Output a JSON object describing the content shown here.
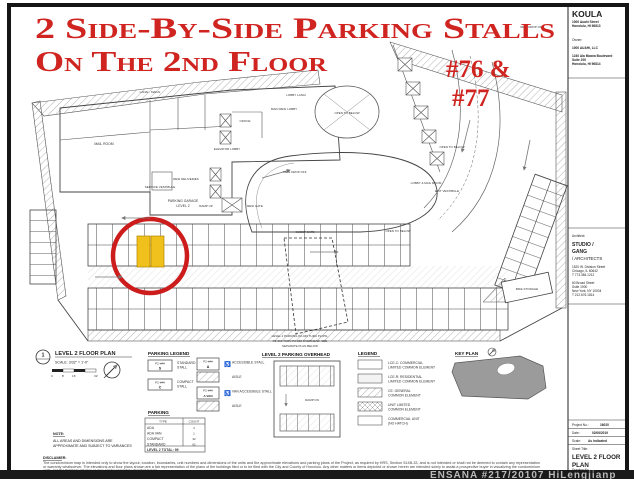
{
  "annotations": {
    "headline_line1": "2 Side-By-Side Parking Stalls",
    "headline_line2": "On The 2nd Floor",
    "callout_line1": "#76 &",
    "callout_line2": "#77",
    "accent_color": "#cf2420",
    "highlight_color": "#f0c11d"
  },
  "title_block": {
    "project": {
      "name": "KOULA",
      "address1": "1000 Auahi Street",
      "address2": "Honolulu, HI 96813"
    },
    "owner": {
      "label": "Owner:",
      "name": "1000 AUAHI, LLC",
      "address1": "1240 Ala Moana Boulevard",
      "address2": "Suite 200",
      "address3": "Honolulu, HI 96814"
    },
    "architect": {
      "label": "Architect:",
      "name1": "STUDIO /",
      "name2": "GANG",
      "name3": "/ ARCHITECTS",
      "chicago1": "1520 W. Division Street",
      "chicago2": "Chicago, IL 60642",
      "chicago3": "T 773.384.1212",
      "ny1": "60 Broad Street",
      "ny2": "Suite 1900",
      "ny3": "New York, NY 10004",
      "ny4": "T 212.676.1814"
    },
    "meta": {
      "project_no_label": "Project No.:",
      "project_no": "16020",
      "date_label": "Date:",
      "date": "02/06/2019",
      "scale_label": "Scale:",
      "scale": "As Indicated",
      "sheet_title_label": "Sheet Title:",
      "sheet_title1": "LEVEL 2 FLOOR",
      "sheet_title2": "PLAN",
      "drawing_no_label": "Drawing No."
    }
  },
  "plan_labels": {
    "lanai_makai": "LANAI - MAKAI",
    "lobby_lanai": "LOBBY LANAI",
    "open_below_oval": "OPEN TO BELOW",
    "open_below_loop": "OPEN TO BELOW",
    "open_below_right": "OPEN TO BELOW",
    "main_resi_lobby": "MAIN RESI LOBBY",
    "office": "OFFICE",
    "mail_room": "MAIL ROOM",
    "elevator_lobby": "ELEVATOR LOBBY",
    "resi_deliveries": "RESI DELIVERIES",
    "service_vestibule": "SERVICE VESTIBULE",
    "parking_garage1": "PARKING GARAGE",
    "parking_garage2": "LEVEL 2",
    "ramp_up": "RAMP UP",
    "resi_gate": "RESI GATE",
    "resi_drop_off": "RESI DROP OFF",
    "resi_drop_off_top": "RESI DROP OFF",
    "guest_gate": "GUEST GATE",
    "bike_storage": "BIKE STORAGE",
    "exit_vestibule": "EXIT VESTIBULE",
    "lobby_mail_room": "LOBBY & MAIL ROOM",
    "overhead_note1": "LEVEL 2 PARKING P2-049 THRU P2-051,",
    "overhead_note2": "P2-061 THRU P2-068 OVERHEAD. SEE",
    "overhead_note3": "SEPARATE PLAN BELOW"
  },
  "drawing_title": {
    "number": "1",
    "title": "LEVEL 2 FLOOR PLAN",
    "scale": "SCALE: 3/32\" = 1'-0\"",
    "tick0": "0",
    "tick1": "8'",
    "tick2": "16'",
    "tick3": "32'"
  },
  "note": {
    "heading": "NOTE:",
    "line1": "ALL AREAS AND DIMENSIONS ARE",
    "line2": "APPROXIMATE AND SUBJECT TO VARIANCES"
  },
  "disclaimer": {
    "heading": "DISCLAIMER:",
    "line1": "The condominium map is intended only to show the layout, location, boundaries, unit numbers and dimensions of the units and the approximate elevations and parking plans of the Project, as required by HRS, Section 514B-33, and is not intended or shall not be deemed to contain any representation",
    "line2": "or warranty whatsoever. The elevations and floor plans shown are a fair representation of the plans of the buildings filed or to be filed with the City and County of Honolulu. Any other matters or items depicted or shown herein are intended solely to assist a prospective buyer in visualizing the condominium",
    "line3": "units, and the finished unit may or may not be accurately depicted herein."
  },
  "parking_legend": {
    "heading": "PARKING LEGEND",
    "standard": {
      "tag": "P2-###",
      "code": "S",
      "label1": "STANDARD",
      "label2": "STALL"
    },
    "compact": {
      "tag": "P2-###",
      "code": "C",
      "label1": "COMPACT",
      "label2": "STALL"
    },
    "accessible": {
      "tag": "P2-###",
      "code": "A",
      "label": "ACCESSIBLE STALL",
      "aisle": "AISLE"
    },
    "van": {
      "tag": "P2-###",
      "code": "A VAN",
      "label": "VAN ACCESSIBLE STALL",
      "aisle": "AISLE"
    },
    "wheelchair_symbol": "♿"
  },
  "parking_table": {
    "heading": "PARKING",
    "col_type": "TYPE",
    "col_count": "COUNT",
    "rows": [
      {
        "type": "ADA",
        "count": "4"
      },
      {
        "type": "ADA VAN",
        "count": "1"
      },
      {
        "type": "COMPACT",
        "count": "32"
      },
      {
        "type": "STANDARD",
        "count": "62"
      }
    ],
    "total": "LEVEL 2 TOTAL: 99"
  },
  "overhead": {
    "heading": "LEVEL 2 PARKING OVERHEAD",
    "ramp_dn": "RAMP DN"
  },
  "legend": {
    "heading": "LEGEND",
    "items": [
      {
        "label1": "LCE-C: COMMERCIAL",
        "label2": "LIMITED COMMON ELEMENT"
      },
      {
        "label1": "LCE-R: RESIDENTIAL",
        "label2": "LIMITED COMMON ELEMENT"
      },
      {
        "label1": "CE: GENERAL",
        "label2": "COMMON ELEMENT"
      },
      {
        "label1": "UNIT LIMITED",
        "label2": "COMMON ELEMENT"
      },
      {
        "label1": "COMMERCIAL UNIT",
        "label2": "(NO HATCH)"
      }
    ]
  },
  "key_plan": {
    "heading": "KEY PLAN"
  },
  "watermark": "ENSANA #217/20107  HiLengjianp"
}
